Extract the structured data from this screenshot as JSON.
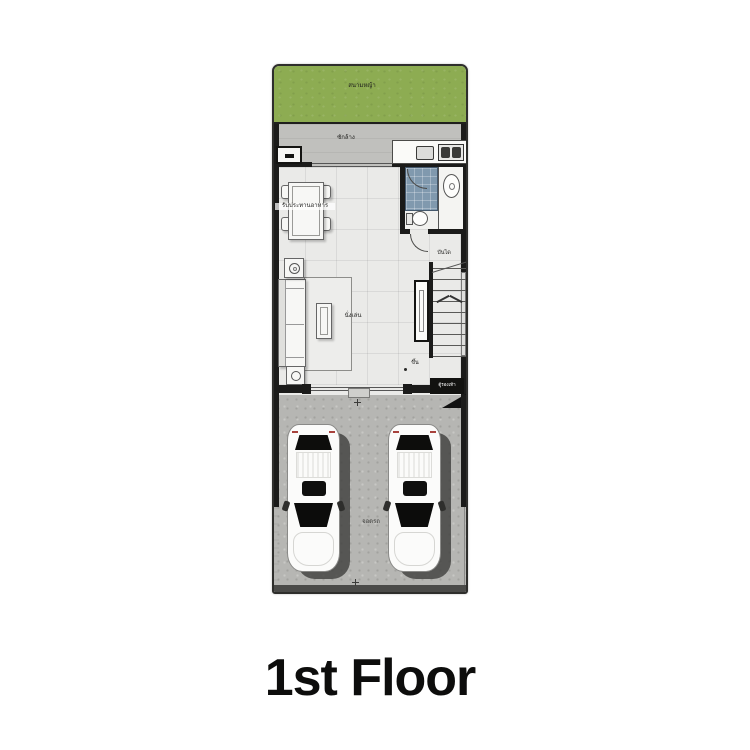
{
  "caption": "1st Floor",
  "plan": {
    "labels": {
      "garden": "สนามหญ้า",
      "wash": "ซักล้าง",
      "dining": "รับประทานอาหาร",
      "living": "นั่งเล่น",
      "stair_hall": "บันได",
      "up": "ขึ้น",
      "shoe": "ตู้รองเท้า",
      "parking": "จอดรถ"
    },
    "colors": {
      "garden_green": "#8dac52",
      "terrace_gray": "#c0c0bd",
      "interior_floor": "#eaeae8",
      "garage_gray": "#b6b6b3",
      "bath_tile_blue": "#8099ae",
      "wall_black": "#1b1b1a",
      "caption_black": "#0d0d0c"
    }
  }
}
